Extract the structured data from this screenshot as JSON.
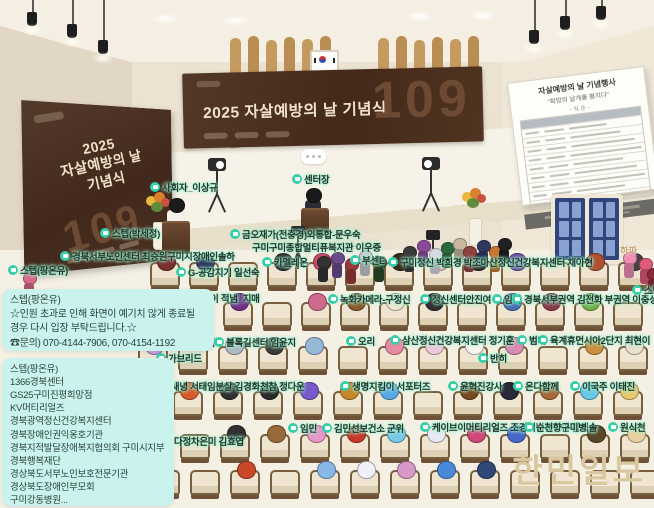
{
  "scene": {
    "poster": {
      "line1": "2025",
      "line2": "자살예방의 날",
      "line3": "기념식",
      "number": "109"
    },
    "banner": {
      "title": "2025 자살예방의 날 기념식",
      "number": "109"
    },
    "board": {
      "title": "자살예방의 날 기념행사",
      "subtitle": "“희망의 날개를 펼치다”",
      "order": "- 식 순 -"
    },
    "watermark": "한민일보",
    "colors": {
      "tag_glow": "#9df2cf",
      "tag_icon": "#35cfa8",
      "chat_bg": "#c9f3ec",
      "banner_bg": "#44291a",
      "watermark": "#d9c79e"
    }
  },
  "chat": {
    "boxes": [
      {
        "lines": [
          "스텝(팡온유)",
          "☆인원 초과로 인해 화면이 예기치 않게 종료될",
          "경우 다시 입장 부탁드립니다.☆",
          "☎문의) 070-4144-7906, 070-4154-1192"
        ]
      },
      {
        "lines": [
          "스텝(팡온유)",
          "1366경북센터",
          "GS25구미진평희망점",
          "KV머티리얼즈",
          "경북광역정신건강복지센터",
          "경북장애인권익옹호기관",
          "경북지적발달장애복지협의회 구미시지부",
          "경북행복재단",
          "경상북도서부노인보호전문기관",
          "경상북도장애인부모회",
          "구미강동병원..."
        ]
      }
    ]
  },
  "nametags": [
    {
      "text": "사회자_이상규",
      "x": 150,
      "y": 180
    },
    {
      "text": "센터장",
      "x": 292,
      "y": 172
    },
    {
      "text": "스텝(박세정)",
      "x": 100,
      "y": 226
    },
    {
      "text": "금오재가(전충경)외통합-문우숙",
      "x": 230,
      "y": 227
    },
    {
      "text": "구미구미종합멀티퓨복지관 이우중",
      "x": 252,
      "y": 240,
      "icon": false
    },
    {
      "text": "경북서부노인센터 최승원구미시장애인솔하",
      "x": 60,
      "y": 249
    },
    {
      "text": "스텝(팡온유)",
      "x": 8,
      "y": 263
    },
    {
      "text": "G-공감지기 일선숙",
      "x": 176,
      "y": 265
    },
    {
      "text": "카멜레온",
      "x": 262,
      "y": 255
    },
    {
      "text": "부센E",
      "x": 350,
      "y": 253
    },
    {
      "text": "구미정신 박희경 박조마산정신건강복지센터 채아현",
      "x": 388,
      "y": 255
    },
    {
      "text": "하파",
      "x": 620,
      "y": 243,
      "icon": false,
      "tan": true
    },
    {
      "text": "한경수 메이 적냄_지매",
      "x": 162,
      "y": 291
    },
    {
      "text": "녹화카메라-구정신",
      "x": 328,
      "y": 292
    },
    {
      "text": "정신센터안진여",
      "x": 420,
      "y": 292
    },
    {
      "text": "임태",
      "x": 492,
      "y": 292
    },
    {
      "text": "경북서부권역 김전화 부권역 이충성",
      "x": 512,
      "y": 292
    },
    {
      "text": "스탭(",
      "x": 632,
      "y": 283
    },
    {
      "text": "지센터",
      "x": 131,
      "y": 334
    },
    {
      "text": "전점",
      "x": 186,
      "y": 335
    },
    {
      "text": "블록길센터 임윤지",
      "x": 214,
      "y": 335
    },
    {
      "text": "오리",
      "x": 346,
      "y": 334
    },
    {
      "text": "삼산정신건강복지센터 정기훈",
      "x": 390,
      "y": 333
    },
    {
      "text": "범띠",
      "x": 517,
      "y": 333
    },
    {
      "text": "육계휴먼시아2단지 최현이",
      "x": 538,
      "y": 333
    },
    {
      "text": "가브리드",
      "x": 156,
      "y": 351
    },
    {
      "text": "반히",
      "x": 478,
      "y": 351
    },
    {
      "text": "할미새녕 서태임분살 김경화천참 정다운",
      "x": 142,
      "y": 379
    },
    {
      "text": "생명지킴이 서포터즈",
      "x": 340,
      "y": 379
    },
    {
      "text": "윤혁진강사",
      "x": 448,
      "y": 379
    },
    {
      "text": "온다함께",
      "x": 513,
      "y": 379
    },
    {
      "text": "이국주 이태진",
      "x": 570,
      "y": 379
    },
    {
      "text": "다정차은미 김효엽",
      "x": 162,
      "y": 434
    },
    {
      "text": "임민",
      "x": 288,
      "y": 421
    },
    {
      "text": "김민선보건소 군위",
      "x": 322,
      "y": 421
    },
    {
      "text": "케이브이머티리얼즈 조경미병복광연 함해솔",
      "x": 420,
      "y": 420
    },
    {
      "text": "순천향구미병",
      "x": 524,
      "y": 420
    },
    {
      "text": "원식천",
      "x": 608,
      "y": 420
    }
  ],
  "seating": [
    {
      "y": 262,
      "x": 150,
      "gap": 39,
      "avatars": [
        "#7a2f2f",
        "#30345c",
        null,
        "#2b2b2b",
        "#c84b6a",
        null,
        "#3a2a1e",
        "#e3b6c0",
        "#2b2b2b",
        "#6b4fa0",
        null,
        "#b05030",
        "#444444"
      ]
    },
    {
      "y": 302,
      "x": 145,
      "gap": 39,
      "avatars": [
        "#b64a3c",
        "#2e3560",
        "#742f8a",
        null,
        "#d06a8c",
        "#8a5a2e",
        "#f0e4d2",
        "#303030",
        null,
        "#4a6fb0",
        "#8a3a4a",
        "#76b04a",
        null
      ]
    },
    {
      "y": 346,
      "x": 138,
      "gap": 40,
      "avatars": [
        "#c8a0e0",
        null,
        "#b0b8c0",
        "#3a3a3a",
        "#98b8d8",
        null,
        "#e88aa0",
        "#f0c8d8",
        "#f8f4ec",
        "#d88ab0",
        null,
        "#c89040",
        "#e8e0d0"
      ]
    },
    {
      "y": 391,
      "x": 133,
      "gap": 40,
      "avatars": [
        "#5a8a3a",
        "#d85a2a",
        "#303030",
        "#2a2a2a",
        "#7a5aca",
        "#c8882a",
        "#58a8e8",
        null,
        "#784820",
        "#282838",
        "#a86838",
        "#68c8e8",
        "#e8c870"
      ]
    },
    {
      "y": 434,
      "x": 140,
      "gap": 40,
      "avatars": [
        "#3a2a5a",
        null,
        "#303030",
        "#9a6a3a",
        "#e898c8",
        "#c83828",
        "#78c8e8",
        "#e8e8f0",
        "#d04878",
        "#4868c8",
        null,
        "#584828",
        "#e8d0a0"
      ]
    },
    {
      "y": 470,
      "x": 150,
      "gap": 40,
      "avatars": [
        null,
        null,
        "#c84828",
        null,
        "#88b8e8",
        "#f0f0f8",
        "#d898c8",
        "#4888d8",
        "#304878",
        null,
        null,
        null,
        null
      ]
    }
  ],
  "standing": [
    {
      "x": 316,
      "y": 256,
      "c": "#333333"
    },
    {
      "x": 330,
      "y": 252,
      "c": "#6a4a8a"
    },
    {
      "x": 344,
      "y": 258,
      "c": "#9a3a3a"
    },
    {
      "x": 358,
      "y": 250,
      "c": "#c8c8d0"
    },
    {
      "x": 372,
      "y": 256,
      "c": "#2a4a2a"
    },
    {
      "x": 402,
      "y": 246,
      "c": "#3a3a3a"
    },
    {
      "x": 416,
      "y": 240,
      "c": "#8a4a9a"
    },
    {
      "x": 428,
      "y": 248,
      "c": "#d8d8e0"
    },
    {
      "x": 440,
      "y": 242,
      "c": "#2a6a3a"
    },
    {
      "x": 452,
      "y": 238,
      "c": "#c8b8a0"
    },
    {
      "x": 462,
      "y": 246,
      "c": "#904040"
    },
    {
      "x": 476,
      "y": 240,
      "c": "#303860"
    },
    {
      "x": 488,
      "y": 246,
      "c": "#c87830"
    },
    {
      "x": 497,
      "y": 238,
      "c": "#202020"
    },
    {
      "x": 622,
      "y": 252,
      "c": "#f090b8"
    },
    {
      "x": 638,
      "y": 258,
      "c": "#e05a7a"
    },
    {
      "x": 646,
      "y": 268,
      "c": "#8a2a3a"
    },
    {
      "x": 22,
      "y": 272,
      "c": "#d86a8a"
    }
  ]
}
